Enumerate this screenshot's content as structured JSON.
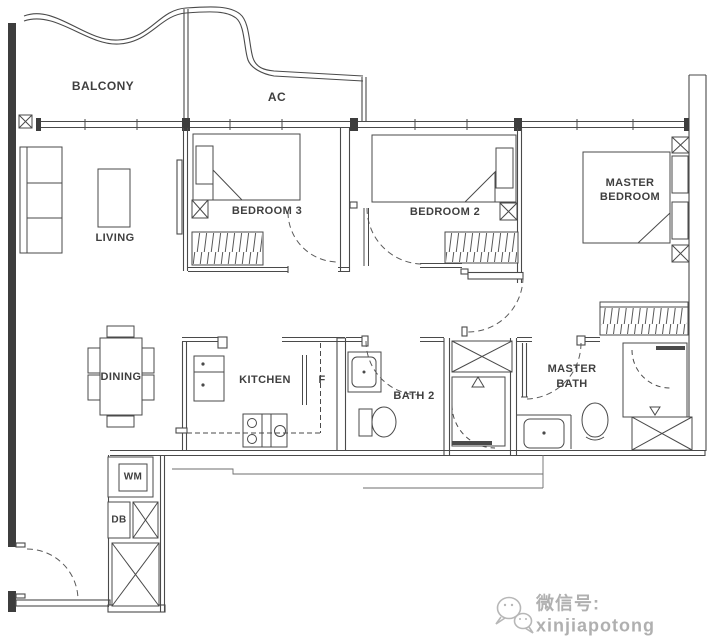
{
  "rooms": {
    "balcony": "BALCONY",
    "ac": "AC",
    "living": "LIVING",
    "bedroom3": "BEDROOM 3",
    "bedroom2": "BEDROOM 2",
    "master_bedroom_line1": "MASTER",
    "master_bedroom_line2": "BEDROOM",
    "dining": "DINING",
    "kitchen": "KITCHEN",
    "fridge": "F",
    "bath2": "BATH 2",
    "master_bath_line1": "MASTER",
    "master_bath_line2": "BATH",
    "washing_machine": "WM",
    "distribution_board": "DB"
  },
  "watermark": {
    "icon": "wechat-icon",
    "text": "微信号: xinjiapotong"
  },
  "colors": {
    "line": "#4a4a4a",
    "wall_fill": "#3d3d3d",
    "background": "#ffffff",
    "watermark": "#b0b0b0"
  }
}
